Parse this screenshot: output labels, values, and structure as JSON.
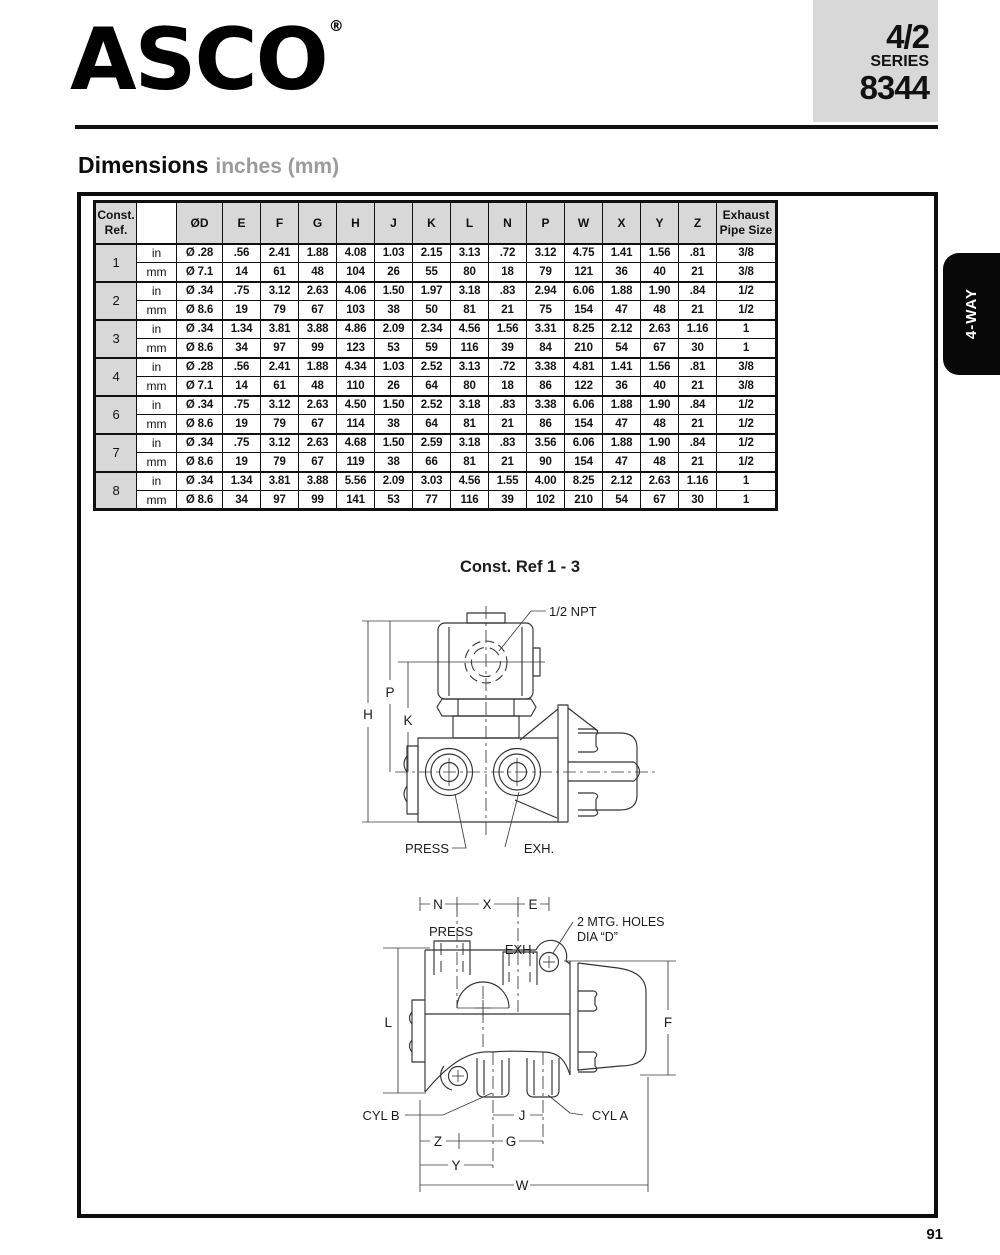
{
  "header": {
    "logo_text": "ASCO",
    "registered_symbol": "®",
    "series_box": {
      "valve_type": "4/2",
      "series_label": "SERIES",
      "series_number": "8344"
    },
    "side_tab": "4-WAY"
  },
  "section": {
    "title": "Dimensions",
    "subtitle": "inches (mm)"
  },
  "table": {
    "col_ref": {
      "line1": "Const.",
      "line2": "Ref."
    },
    "col_exhaust": {
      "line1": "Exhaust",
      "line2": "Pipe Size"
    },
    "columns": [
      "ØD",
      "E",
      "F",
      "G",
      "H",
      "J",
      "K",
      "L",
      "N",
      "P",
      "W",
      "X",
      "Y",
      "Z"
    ],
    "groups": [
      {
        "ref": "1",
        "rows": [
          {
            "unit": "in",
            "values": [
              "Ø .28",
              ".56",
              "2.41",
              "1.88",
              "4.08",
              "1.03",
              "2.15",
              "3.13",
              ".72",
              "3.12",
              "4.75",
              "1.41",
              "1.56",
              ".81"
            ],
            "exhaust": "3/8"
          },
          {
            "unit": "mm",
            "values": [
              "Ø 7.1",
              "14",
              "61",
              "48",
              "104",
              "26",
              "55",
              "80",
              "18",
              "79",
              "121",
              "36",
              "40",
              "21"
            ],
            "exhaust": "3/8"
          }
        ]
      },
      {
        "ref": "2",
        "rows": [
          {
            "unit": "in",
            "values": [
              "Ø .34",
              ".75",
              "3.12",
              "2.63",
              "4.06",
              "1.50",
              "1.97",
              "3.18",
              ".83",
              "2.94",
              "6.06",
              "1.88",
              "1.90",
              ".84"
            ],
            "exhaust": "1/2"
          },
          {
            "unit": "mm",
            "values": [
              "Ø 8.6",
              "19",
              "79",
              "67",
              "103",
              "38",
              "50",
              "81",
              "21",
              "75",
              "154",
              "47",
              "48",
              "21"
            ],
            "exhaust": "1/2"
          }
        ]
      },
      {
        "ref": "3",
        "rows": [
          {
            "unit": "in",
            "values": [
              "Ø .34",
              "1.34",
              "3.81",
              "3.88",
              "4.86",
              "2.09",
              "2.34",
              "4.56",
              "1.56",
              "3.31",
              "8.25",
              "2.12",
              "2.63",
              "1.16"
            ],
            "exhaust": "1"
          },
          {
            "unit": "mm",
            "values": [
              "Ø 8.6",
              "34",
              "97",
              "99",
              "123",
              "53",
              "59",
              "116",
              "39",
              "84",
              "210",
              "54",
              "67",
              "30"
            ],
            "exhaust": "1"
          }
        ]
      },
      {
        "ref": "4",
        "rows": [
          {
            "unit": "in",
            "values": [
              "Ø .28",
              ".56",
              "2.41",
              "1.88",
              "4.34",
              "1.03",
              "2.52",
              "3.13",
              ".72",
              "3.38",
              "4.81",
              "1.41",
              "1.56",
              ".81"
            ],
            "exhaust": "3/8"
          },
          {
            "unit": "mm",
            "values": [
              "Ø 7.1",
              "14",
              "61",
              "48",
              "110",
              "26",
              "64",
              "80",
              "18",
              "86",
              "122",
              "36",
              "40",
              "21"
            ],
            "exhaust": "3/8"
          }
        ]
      },
      {
        "ref": "6",
        "rows": [
          {
            "unit": "in",
            "values": [
              "Ø .34",
              ".75",
              "3.12",
              "2.63",
              "4.50",
              "1.50",
              "2.52",
              "3.18",
              ".83",
              "3.38",
              "6.06",
              "1.88",
              "1.90",
              ".84"
            ],
            "exhaust": "1/2"
          },
          {
            "unit": "mm",
            "values": [
              "Ø 8.6",
              "19",
              "79",
              "67",
              "114",
              "38",
              "64",
              "81",
              "21",
              "86",
              "154",
              "47",
              "48",
              "21"
            ],
            "exhaust": "1/2"
          }
        ]
      },
      {
        "ref": "7",
        "rows": [
          {
            "unit": "in",
            "values": [
              "Ø .34",
              ".75",
              "3.12",
              "2.63",
              "4.68",
              "1.50",
              "2.59",
              "3.18",
              ".83",
              "3.56",
              "6.06",
              "1.88",
              "1.90",
              ".84"
            ],
            "exhaust": "1/2"
          },
          {
            "unit": "mm",
            "values": [
              "Ø 8.6",
              "19",
              "79",
              "67",
              "119",
              "38",
              "66",
              "81",
              "21",
              "90",
              "154",
              "47",
              "48",
              "21"
            ],
            "exhaust": "1/2"
          }
        ]
      },
      {
        "ref": "8",
        "rows": [
          {
            "unit": "in",
            "values": [
              "Ø .34",
              "1.34",
              "3.81",
              "3.88",
              "5.56",
              "2.09",
              "3.03",
              "4.56",
              "1.55",
              "4.00",
              "8.25",
              "2.12",
              "2.63",
              "1.16"
            ],
            "exhaust": "1"
          },
          {
            "unit": "mm",
            "values": [
              "Ø 8.6",
              "34",
              "97",
              "99",
              "141",
              "53",
              "77",
              "116",
              "39",
              "102",
              "210",
              "54",
              "67",
              "30"
            ],
            "exhaust": "1"
          }
        ]
      }
    ]
  },
  "diagram1": {
    "title": "Const. Ref 1 - 3",
    "labels": {
      "npt": "1/2 NPT",
      "press": "PRESS",
      "exh": "EXH.",
      "dim_h": "H",
      "dim_p": "P",
      "dim_k": "K"
    }
  },
  "diagram2": {
    "labels": {
      "dim_n": "N",
      "dim_x": "X",
      "dim_e": "E",
      "press": "PRESS",
      "exh": "EXH.",
      "mtg_line1": "2 MTG. HOLES",
      "mtg_line2": "DIA “D”",
      "dim_l": "L",
      "dim_f": "F",
      "cyl_b": "CYL B",
      "dim_j": "J",
      "cyl_a": "CYL A",
      "dim_z": "Z",
      "dim_g": "G",
      "dim_y": "Y",
      "dim_w": "W"
    }
  },
  "footer": {
    "page_number": "91"
  }
}
